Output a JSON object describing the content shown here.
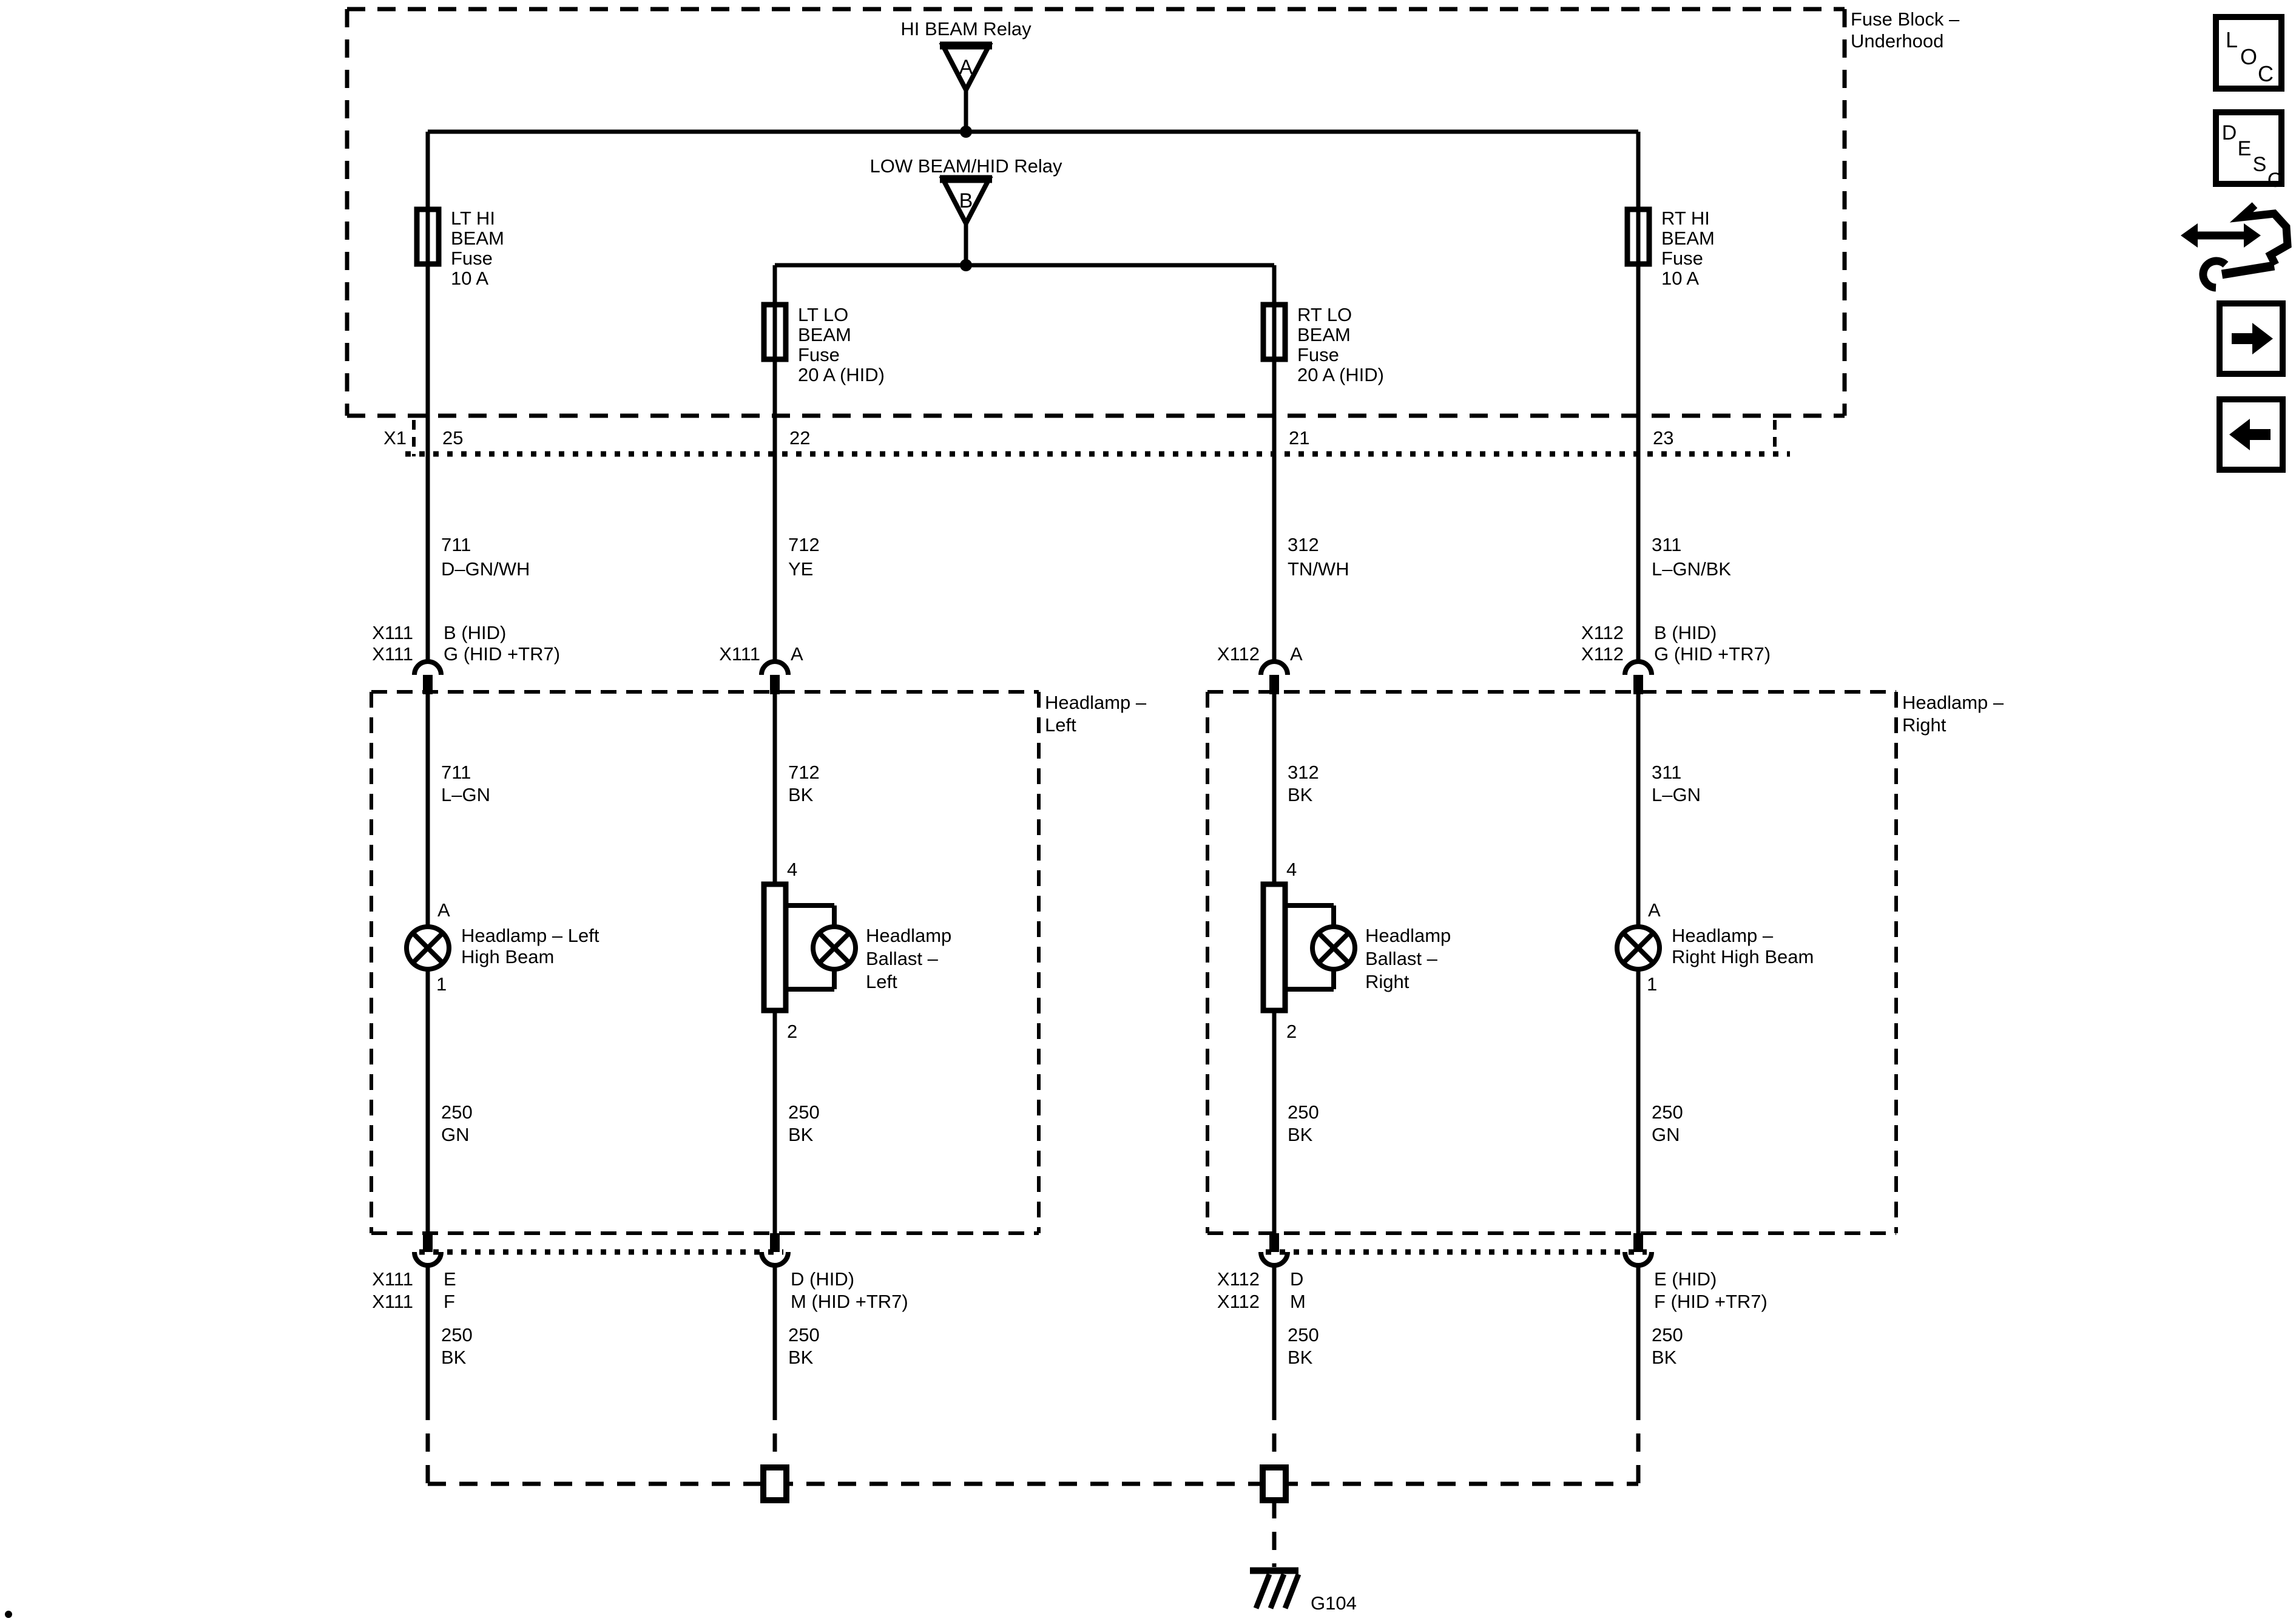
{
  "colors": {
    "ink": "#000000",
    "paper": "#ffffff"
  },
  "fuse_block": {
    "label_lines": [
      "Fuse Block –",
      "Underhood"
    ],
    "connector": "X1",
    "relays": [
      {
        "id": "A",
        "label": "HI BEAM Relay"
      },
      {
        "id": "B",
        "label": "LOW BEAM/HID Relay"
      }
    ]
  },
  "headlamp_boxes": [
    {
      "id": "left",
      "label_lines": [
        "Headlamp –",
        "Left"
      ]
    },
    {
      "id": "right",
      "label_lines": [
        "Headlamp –",
        "Right"
      ]
    }
  ],
  "ground": {
    "id": "G104"
  },
  "columns": [
    {
      "id": "lt-hi-beam",
      "fuse_lines": [
        "LT HI",
        "BEAM",
        "Fuse",
        "10 A"
      ],
      "block_pin": "25",
      "wire_upper": [
        "711",
        "D–GN/WH"
      ],
      "conn_top_left": [
        "X111",
        "X111"
      ],
      "conn_top_right": [
        "B (HID)",
        "G (HID +TR7)"
      ],
      "wire_inner": [
        "711",
        "L–GN"
      ],
      "component": {
        "type": "lamp",
        "pin_top": "A",
        "pin_bottom": "1",
        "label_lines": [
          "Headlamp – Left",
          "High Beam"
        ]
      },
      "wire_lower": [
        "250",
        "GN"
      ],
      "conn_bot_left": [
        "X111",
        "X111"
      ],
      "conn_bot_right": [
        "E",
        "F"
      ],
      "wire_ground": [
        "250",
        "BK"
      ]
    },
    {
      "id": "lt-lo-beam",
      "fuse_lines": [
        "LT LO",
        "BEAM",
        "Fuse",
        "20 A (HID)"
      ],
      "block_pin": "22",
      "wire_upper": [
        "712",
        "YE"
      ],
      "conn_top_left": [
        "X111"
      ],
      "conn_top_right": [
        "A"
      ],
      "wire_inner": [
        "712",
        "BK"
      ],
      "component": {
        "type": "ballast",
        "pin_top": "4",
        "pin_bottom": "2",
        "label_lines": [
          "Headlamp",
          "Ballast –",
          "Left"
        ]
      },
      "wire_lower": [
        "250",
        "BK"
      ],
      "conn_bot_left": [],
      "conn_bot_right": [
        "D (HID)",
        "M (HID +TR7)"
      ],
      "wire_ground": [
        "250",
        "BK"
      ]
    },
    {
      "id": "rt-lo-beam",
      "fuse_lines": [
        "RT LO",
        "BEAM",
        "Fuse",
        "20 A (HID)"
      ],
      "block_pin": "21",
      "wire_upper": [
        "312",
        "TN/WH"
      ],
      "conn_top_left": [
        "X112"
      ],
      "conn_top_right": [
        "A"
      ],
      "wire_inner": [
        "312",
        "BK"
      ],
      "component": {
        "type": "ballast",
        "pin_top": "4",
        "pin_bottom": "2",
        "label_lines": [
          "Headlamp",
          "Ballast –",
          "Right"
        ]
      },
      "wire_lower": [
        "250",
        "BK"
      ],
      "conn_bot_left": [
        "X112",
        "X112"
      ],
      "conn_bot_right": [
        "D",
        "M"
      ],
      "wire_ground": [
        "250",
        "BK"
      ]
    },
    {
      "id": "rt-hi-beam",
      "fuse_lines": [
        "RT HI",
        "BEAM",
        "Fuse",
        "10 A"
      ],
      "block_pin": "23",
      "wire_upper": [
        "311",
        "L–GN/BK"
      ],
      "conn_top_left": [
        "X112",
        "X112"
      ],
      "conn_top_right": [
        "B (HID)",
        "G (HID +TR7)"
      ],
      "wire_inner": [
        "311",
        "L–GN"
      ],
      "component": {
        "type": "lamp",
        "pin_top": "A",
        "pin_bottom": "1",
        "label_lines": [
          "Headlamp –",
          "Right High Beam"
        ]
      },
      "wire_lower": [
        "250",
        "GN"
      ],
      "conn_bot_left": [],
      "conn_bot_right": [
        "E (HID)",
        "F (HID +TR7)"
      ],
      "wire_ground": [
        "250",
        "BK"
      ]
    }
  ],
  "sidebar": {
    "loc_letters": [
      "L",
      "O",
      "C"
    ],
    "desc_letters": [
      "D",
      "E",
      "S",
      "C"
    ],
    "icons": [
      "loc-icon",
      "desc-icon",
      "wrench-arrows-icon",
      "next-arrow-icon",
      "prev-arrow-icon"
    ]
  }
}
